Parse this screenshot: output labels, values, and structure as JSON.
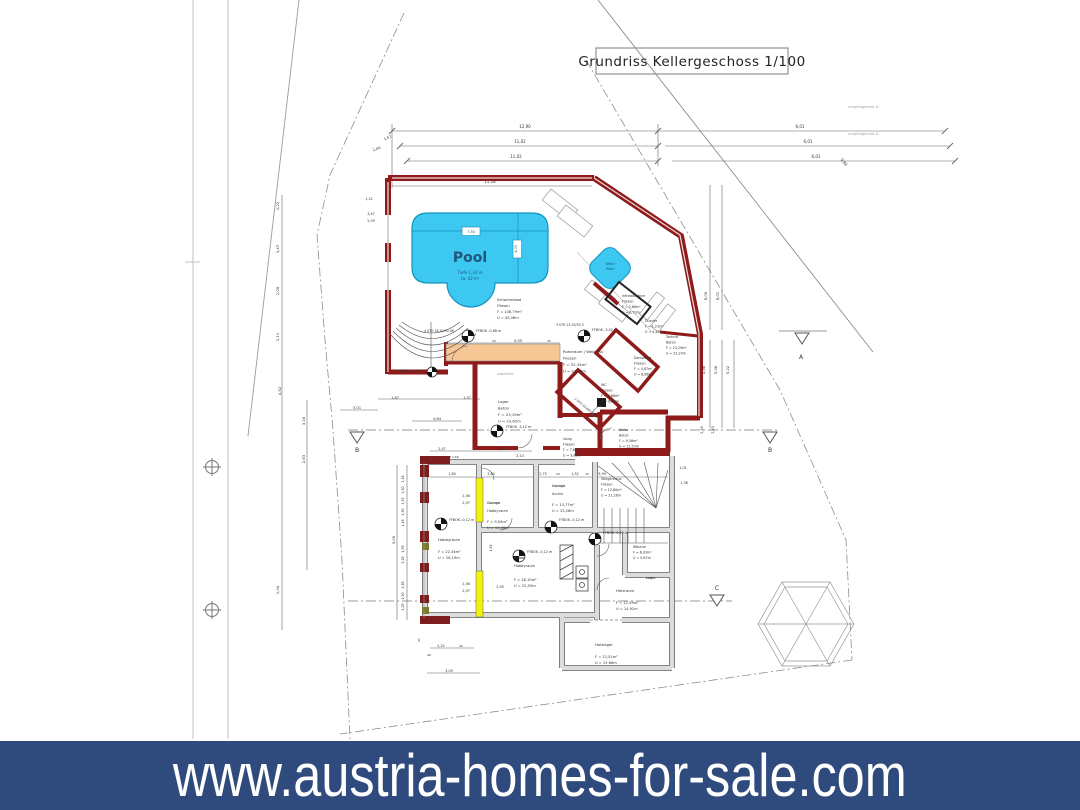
{
  "title_block": {
    "label": "Grundriss  Kellergeschoss 1/100"
  },
  "banner": {
    "url": "www.austria-homes-for-sale.com"
  },
  "colors": {
    "banner_bg": "#2F4A7D",
    "wall_red": "#8E1A1A",
    "pool_fill": "#3CC8F0",
    "sauna_strip": "#F6C795",
    "new_wall_yellow": "#F2F20C"
  },
  "plan": {
    "annotations": [
      {
        "n": "room-label-schwimmbad",
        "l": [
          "Schwimmbad",
          "Fliesen",
          "F = 108,79m²",
          "U = 45,08m"
        ],
        "x": 497,
        "y": 301,
        "s": 3.6,
        "h": 6,
        "a": "start"
      },
      {
        "n": "pool-name",
        "t": "Pool",
        "x": 470,
        "y": 262,
        "s": 14,
        "c": "#20567A",
        "w": "600"
      },
      {
        "n": "pool-info",
        "l": [
          "Tiefe 1,34 m",
          "ca. 42 m²"
        ],
        "x": 470,
        "y": 274,
        "s": 4,
        "h": 6,
        "c": "#20567A"
      },
      {
        "n": "room-label-whirlpool",
        "l": [
          "Whirl",
          "Pool"
        ],
        "x": 610,
        "y": 265,
        "s": 3.6,
        "h": 5,
        "c": "#14506E"
      },
      {
        "n": "room-label-infrarotkabine",
        "l": [
          "Infrarotkabine",
          "Fliesen",
          "F = 2,68m²",
          "U = 6,70m"
        ],
        "x": 622,
        "y": 297,
        "s": 3.3,
        "h": 5.5,
        "a": "start"
      },
      {
        "n": "room-label-dusche",
        "l": [
          "Dusche",
          "F = 1,23m²",
          "U = 4,43m"
        ],
        "x": 645,
        "y": 322,
        "s": 3.3,
        "h": 5.5,
        "a": "start"
      },
      {
        "n": "room-label-technik",
        "l": [
          "Technik",
          "Beton",
          "F = 10,29m²",
          "U = 22,24m"
        ],
        "x": 666,
        "y": 338,
        "s": 3.3,
        "h": 5.5,
        "a": "start"
      },
      {
        "n": "room-label-dampfbad",
        "l": [
          "Dampfbad",
          "Fliesen",
          "F = 4,87m²",
          "U = 8,86m"
        ],
        "x": 634,
        "y": 359,
        "s": 3.3,
        "h": 5.5,
        "a": "start"
      },
      {
        "n": "room-label-wc",
        "l": [
          "WC",
          "Fliesen",
          "F = 4,68m²",
          "U = 8,87m"
        ],
        "x": 601,
        "y": 386,
        "s": 3.3,
        "h": 5.5,
        "a": "start"
      },
      {
        "n": "room-label-ruheraum",
        "l": [
          "Ruheraum / Wellness",
          "Fliesen",
          "F = 32,34m²",
          "U = 23,73m"
        ],
        "x": 563,
        "y": 353,
        "s": 3.8,
        "h": 6.5,
        "a": "start"
      },
      {
        "n": "room-label-lager",
        "l": [
          "Lager",
          "Beton",
          "F = 23,19m²",
          "U = 23,62m"
        ],
        "x": 498,
        "y": 403,
        "s": 3.8,
        "h": 6.5,
        "a": "start"
      },
      {
        "n": "microtext",
        "t": "unbeheizt",
        "x": 497,
        "y": 375,
        "s": 3.3,
        "c": "#999",
        "a": "start"
      },
      {
        "n": "room-label-gang",
        "l": [
          "Gang",
          "Fliesen",
          "F = 7,62m²",
          "U = 9,82m"
        ],
        "x": 563,
        "y": 440,
        "s": 3.3,
        "h": 5.5,
        "a": "start"
      },
      {
        "n": "room-label-keller",
        "l": [
          "Keller",
          "Beton",
          "F = 9,56m²",
          "U = 12,53m"
        ],
        "x": 619,
        "y": 431,
        "s": 3.3,
        "h": 5.5,
        "a": "start"
      },
      {
        "n": "room-label-stiegenhaus",
        "l": [
          "Stiegenhaus",
          "Fliesen",
          "F = 12,60m²",
          "U = 21,28m"
        ],
        "x": 601,
        "y": 480,
        "s": 3.3,
        "h": 5.5,
        "a": "start"
      },
      {
        "n": "strike-garage-1",
        "t": "Garage",
        "x": 552,
        "y": 487,
        "s": 3.6,
        "a": "start",
        "k": true
      },
      {
        "n": "room-label-archiv",
        "t": "Archiv",
        "x": 552,
        "y": 495,
        "s": 3.6,
        "a": "start"
      },
      {
        "n": "room-info-archiv",
        "l": [
          "F = 13,77m²",
          "U = 15,26m"
        ],
        "x": 552,
        "y": 506,
        "s": 3.6,
        "h": 6,
        "a": "start"
      },
      {
        "n": "strike-garage-2",
        "t": "Garage",
        "x": 487,
        "y": 504,
        "s": 3.6,
        "a": "start",
        "k": true
      },
      {
        "n": "room-label-hobbyraum-2",
        "t": "Hobbyraum",
        "x": 487,
        "y": 512,
        "s": 3.6,
        "a": "start"
      },
      {
        "n": "room-info-hobbyraum-2",
        "l": [
          "F = 9,04m²",
          "U = 10,46m"
        ],
        "x": 487,
        "y": 523,
        "s": 3.6,
        "h": 6,
        "a": "start"
      },
      {
        "n": "room-label-hobbyraum-1",
        "t": "Hobbyraum",
        "x": 438,
        "y": 541,
        "s": 3.8,
        "a": "start"
      },
      {
        "n": "room-info-hobbyraum-1",
        "l": [
          "F = 22,34m²",
          "U = 26,19m"
        ],
        "x": 438,
        "y": 553,
        "s": 3.6,
        "h": 6,
        "a": "start"
      },
      {
        "n": "strike-keller",
        "t": "Keller",
        "x": 514,
        "y": 559,
        "s": 3.6,
        "a": "start",
        "k": true
      },
      {
        "n": "room-label-hobbyraum-3",
        "t": "Hobbyraum",
        "x": 514,
        "y": 567,
        "s": 3.6,
        "a": "start"
      },
      {
        "n": "room-info-hobbyraum-3",
        "l": [
          "F = 28,10m²",
          "U = 22,53m"
        ],
        "x": 514,
        "y": 581,
        "s": 3.6,
        "h": 6,
        "a": "start"
      },
      {
        "n": "room-label-waesche",
        "l": [
          "Wäsche",
          "F = 6,03m²",
          "U = 9,87m"
        ],
        "x": 633,
        "y": 548,
        "s": 3.3,
        "h": 5.5,
        "a": "start"
      },
      {
        "n": "strike-lager",
        "t": "Lager",
        "x": 646,
        "y": 579,
        "s": 3.3,
        "a": "start",
        "k": true
      },
      {
        "n": "room-label-heizraum",
        "t": "Heizraum",
        "x": 616,
        "y": 592,
        "s": 3.8,
        "a": "start"
      },
      {
        "n": "room-info-heizraum",
        "l": [
          "F = 12,59m²",
          "U = 14,92m"
        ],
        "x": 616,
        "y": 604,
        "s": 3.6,
        "h": 6,
        "a": "start"
      },
      {
        "n": "room-label-holzlager",
        "t": "Holzlager",
        "x": 595,
        "y": 646,
        "s": 3.8,
        "a": "start"
      },
      {
        "n": "room-info-holzlager",
        "l": [
          "F = 12,51m²",
          "U = 15,66m"
        ],
        "x": 595,
        "y": 658,
        "s": 3.6,
        "h": 6,
        "a": "start"
      },
      {
        "n": "stair-note",
        "t": "4 STH 16,20/30,06",
        "x": 424,
        "y": 332,
        "s": 3.2,
        "a": "start"
      },
      {
        "n": "stair-note",
        "t": "3 STH 15,30/30,5",
        "x": 556,
        "y": 326,
        "s": 3.2,
        "a": "start"
      },
      {
        "n": "stair-note",
        "t": "2 STH 15,60/32,05",
        "x": 574,
        "y": 399,
        "s": 3.2,
        "a": "start",
        "r": 40
      },
      {
        "n": "ffbok-label",
        "t": "FFBOK -0,88 m",
        "x": 476,
        "y": 332,
        "s": 3.4,
        "a": "start"
      },
      {
        "n": "ffbok-label",
        "t": "FFBOK -3,42 m",
        "x": 592,
        "y": 331,
        "s": 3.4,
        "a": "start"
      },
      {
        "n": "ffbok-label",
        "t": "FFBOK -3,07 m",
        "x": 398,
        "y": 372,
        "s": 3.4,
        "a": "start"
      },
      {
        "n": "ffbok-label",
        "t": "FFBOK -3,12 m",
        "x": 506,
        "y": 428,
        "s": 3.4,
        "a": "start"
      },
      {
        "n": "ffbok-label",
        "t": "FFBOK -0,12 m",
        "x": 449,
        "y": 521,
        "s": 3.4,
        "a": "start"
      },
      {
        "n": "ffbok-label",
        "t": "FFBOK -0,12 m",
        "x": 559,
        "y": 521,
        "s": 3.4,
        "a": "start"
      },
      {
        "n": "ffbok-label",
        "t": "FFBOK -0,12 m",
        "x": 603,
        "y": 534,
        "s": 3.4,
        "a": "start"
      },
      {
        "n": "ffbok-label",
        "t": "FFBOK -0,12 m",
        "x": 527,
        "y": 553,
        "s": 3.4,
        "a": "start"
      },
      {
        "n": "note-gelaende",
        "t": "ursprüngliches G.",
        "x": 848,
        "y": 108,
        "s": 3.6,
        "c": "#999",
        "a": "start"
      },
      {
        "n": "note-gelaende",
        "t": "ursprüngliches G.",
        "x": 848,
        "y": 135,
        "s": 3.6,
        "c": "#999",
        "a": "start"
      },
      {
        "n": "section-label-a",
        "t": "A",
        "x": 801,
        "y": 359,
        "s": 6
      },
      {
        "n": "section-label-b",
        "t": "B",
        "x": 357,
        "y": 452,
        "s": 6
      },
      {
        "n": "section-label-b",
        "t": "B",
        "x": 770,
        "y": 452,
        "s": 6
      },
      {
        "n": "section-label-c",
        "t": "C",
        "x": 717,
        "y": 590,
        "s": 6
      },
      {
        "n": "pool-dim",
        "t": "7,50",
        "x": 471,
        "y": 233,
        "s": 3.4,
        "c": "#14506E"
      },
      {
        "n": "pool-dim",
        "t": "4,00",
        "x": 517,
        "y": 249,
        "s": 3.4,
        "r": -90,
        "c": "#14506E"
      },
      {
        "n": "dim",
        "t": "12,90",
        "x": 525,
        "y": 128
      },
      {
        "n": "dim",
        "t": "11,02",
        "x": 520,
        "y": 143
      },
      {
        "n": "dim",
        "t": "11,02",
        "x": 516,
        "y": 158
      },
      {
        "n": "dim",
        "t": "11,18",
        "x": 490,
        "y": 183
      },
      {
        "n": "dim",
        "t": "6,01",
        "x": 800,
        "y": 128
      },
      {
        "n": "dim",
        "t": "6,01",
        "x": 808,
        "y": 143
      },
      {
        "n": "dim",
        "t": "6,01",
        "x": 816,
        "y": 158
      },
      {
        "n": "dim",
        "t": "1,57",
        "x": 388,
        "y": 139,
        "r": -20,
        "s": 3.6
      },
      {
        "n": "dim",
        "t": "2,04",
        "x": 377,
        "y": 150,
        "r": -20,
        "s": 3.6
      },
      {
        "n": "dim",
        "t": "9,96",
        "x": 843,
        "y": 163,
        "r": 52,
        "s": 3.8
      },
      {
        "n": "dim",
        "t": "8,09",
        "x": 707,
        "y": 296,
        "r": -90,
        "s": 3.8
      },
      {
        "n": "dim",
        "t": "8,01",
        "x": 719,
        "y": 296,
        "r": -90,
        "s": 3.8
      },
      {
        "n": "dim",
        "t": "4,98",
        "x": 705,
        "y": 370,
        "r": -90,
        "s": 3.8
      },
      {
        "n": "dim",
        "t": "5,06",
        "x": 717,
        "y": 370,
        "r": -90,
        "s": 3.8
      },
      {
        "n": "dim",
        "t": "5,22",
        "x": 729,
        "y": 370,
        "r": -90,
        "s": 3.8
      },
      {
        "n": "dim",
        "t": "1,22",
        "x": 279,
        "y": 206,
        "r": -90,
        "s": 3.8
      },
      {
        "n": "dim",
        "t": "3,47",
        "x": 279,
        "y": 249,
        "r": -90,
        "s": 3.8
      },
      {
        "n": "dim",
        "t": "2,09",
        "x": 279,
        "y": 291,
        "r": -90,
        "s": 3.8
      },
      {
        "n": "dim",
        "t": "2,11",
        "x": 279,
        "y": 337,
        "r": -90,
        "s": 3.8
      },
      {
        "n": "dim",
        "t": "4,52",
        "x": 281,
        "y": 391,
        "r": -90,
        "s": 3.8
      },
      {
        "n": "dim",
        "t": "1,04",
        "x": 279,
        "y": 590,
        "r": -90,
        "s": 3.8
      },
      {
        "n": "dim",
        "t": "3,16",
        "x": 305,
        "y": 421,
        "r": -90,
        "s": 3.8
      },
      {
        "n": "dim",
        "t": "2,63",
        "x": 305,
        "y": 459,
        "r": -90,
        "s": 3.8
      },
      {
        "n": "dim",
        "t": "3,47",
        "x": 371,
        "y": 215,
        "s": 3.4
      },
      {
        "n": "dim",
        "t": "2,09",
        "x": 371,
        "y": 222,
        "s": 3.4
      },
      {
        "n": "dim",
        "t": "1,22",
        "x": 369,
        "y": 200,
        "s": 3.4
      },
      {
        "n": "dim",
        "t": "3,01",
        "x": 357,
        "y": 409,
        "s": 3.8
      },
      {
        "n": "dim",
        "t": "1,87",
        "x": 395,
        "y": 399,
        "s": 3.4
      },
      {
        "n": "dim",
        "t": "1,97",
        "x": 467,
        "y": 399,
        "s": 3.4
      },
      {
        "n": "dim",
        "t": "4,84",
        "x": 437,
        "y": 420,
        "s": 3.8
      },
      {
        "n": "dim",
        "t": "2,47",
        "x": 442,
        "y": 450,
        "s": 3.4
      },
      {
        "n": "dim",
        "t": "2,12",
        "x": 502,
        "y": 450,
        "s": 3.4
      },
      {
        "n": "dim",
        "t": "2,10",
        "x": 520,
        "y": 457,
        "s": 3.4
      },
      {
        "n": "dim",
        "t": "FPH 1,56",
        "x": 452,
        "y": 458,
        "s": 3
      },
      {
        "n": "dim",
        "t": "1,80",
        "x": 452,
        "y": 475,
        "s": 3.4
      },
      {
        "n": "dim",
        "t": "3,80",
        "x": 491,
        "y": 475,
        "s": 3.4
      },
      {
        "n": "dim",
        "t": "2,75",
        "x": 543,
        "y": 475,
        "s": 3.4
      },
      {
        "n": "dim",
        "t": "25",
        "x": 558,
        "y": 475,
        "s": 3
      },
      {
        "n": "dim",
        "t": "1,52",
        "x": 575,
        "y": 475,
        "s": 3.4
      },
      {
        "n": "dim",
        "t": "15",
        "x": 587,
        "y": 475,
        "s": 3
      },
      {
        "n": "dim",
        "t": "3,99",
        "x": 602,
        "y": 475,
        "s": 3.4
      },
      {
        "n": "dim",
        "t": "1,01",
        "x": 683,
        "y": 469,
        "s": 3.4
      },
      {
        "n": "dim",
        "t": "1,38",
        "x": 684,
        "y": 484,
        "s": 3.4
      },
      {
        "n": "dim",
        "t": "2,45",
        "x": 703,
        "y": 430,
        "r": -90,
        "s": 3.4
      },
      {
        "n": "dim",
        "t": "2,43",
        "x": 714,
        "y": 430,
        "r": -90,
        "s": 3.4
      },
      {
        "n": "dim",
        "t": "4,55",
        "x": 518,
        "y": 342,
        "s": 3.8
      },
      {
        "n": "dim",
        "t": "25",
        "x": 494,
        "y": 342,
        "s": 3
      },
      {
        "n": "dim",
        "t": "25",
        "x": 549,
        "y": 342,
        "s": 3
      },
      {
        "n": "dim",
        "t": "1,16",
        "x": 404,
        "y": 479,
        "r": -90,
        "s": 3.2
      },
      {
        "n": "dim",
        "t": "1,30",
        "x": 404,
        "y": 490,
        "r": -90,
        "s": 3.2
      },
      {
        "n": "dim",
        "t": "1,55",
        "x": 404,
        "y": 501,
        "r": -90,
        "s": 3.2
      },
      {
        "n": "dim",
        "t": "1,30",
        "x": 404,
        "y": 512,
        "r": -90,
        "s": 3.2
      },
      {
        "n": "dim",
        "t": "1,16",
        "x": 404,
        "y": 523,
        "r": -90,
        "s": 3.2
      },
      {
        "n": "dim",
        "t": "1,39",
        "x": 404,
        "y": 549,
        "r": -90,
        "s": 3.2
      },
      {
        "n": "dim",
        "t": "1,28",
        "x": 404,
        "y": 560,
        "r": -90,
        "s": 3.2
      },
      {
        "n": "dim",
        "t": "1,56",
        "x": 404,
        "y": 585,
        "r": -90,
        "s": 3.2
      },
      {
        "n": "dim",
        "t": "1,30",
        "x": 404,
        "y": 596,
        "r": -90,
        "s": 3.2
      },
      {
        "n": "dim",
        "t": "1,29",
        "x": 404,
        "y": 607,
        "r": -90,
        "s": 3.2
      },
      {
        "n": "dim",
        "t": "9,06",
        "x": 395,
        "y": 540,
        "r": -90,
        "s": 3.6
      },
      {
        "n": "dim",
        "t": "2,36",
        "x": 466,
        "y": 497,
        "s": 3.4
      },
      {
        "n": "dim",
        "t": "2,07",
        "x": 466,
        "y": 504,
        "s": 3.4
      },
      {
        "n": "dim",
        "t": "2,36",
        "x": 466,
        "y": 585,
        "s": 3.4
      },
      {
        "n": "dim",
        "t": "2,07",
        "x": 466,
        "y": 592,
        "s": 3.4
      },
      {
        "n": "dim",
        "t": "2,90",
        "x": 500,
        "y": 588,
        "s": 3.4
      },
      {
        "n": "dim",
        "t": "1,55",
        "x": 492,
        "y": 548,
        "r": -90,
        "s": 3.2
      },
      {
        "n": "dim",
        "t": "2,22",
        "x": 441,
        "y": 647,
        "s": 3.4
      },
      {
        "n": "dim",
        "t": "92",
        "x": 461,
        "y": 647,
        "s": 3
      },
      {
        "n": "dim",
        "t": "46",
        "x": 429,
        "y": 656,
        "s": 3
      },
      {
        "n": "dim",
        "t": "3,09",
        "x": 449,
        "y": 672,
        "s": 3.4
      },
      {
        "n": "dim",
        "t": "65",
        "x": 420,
        "y": 640,
        "r": -90,
        "s": 3
      }
    ]
  }
}
